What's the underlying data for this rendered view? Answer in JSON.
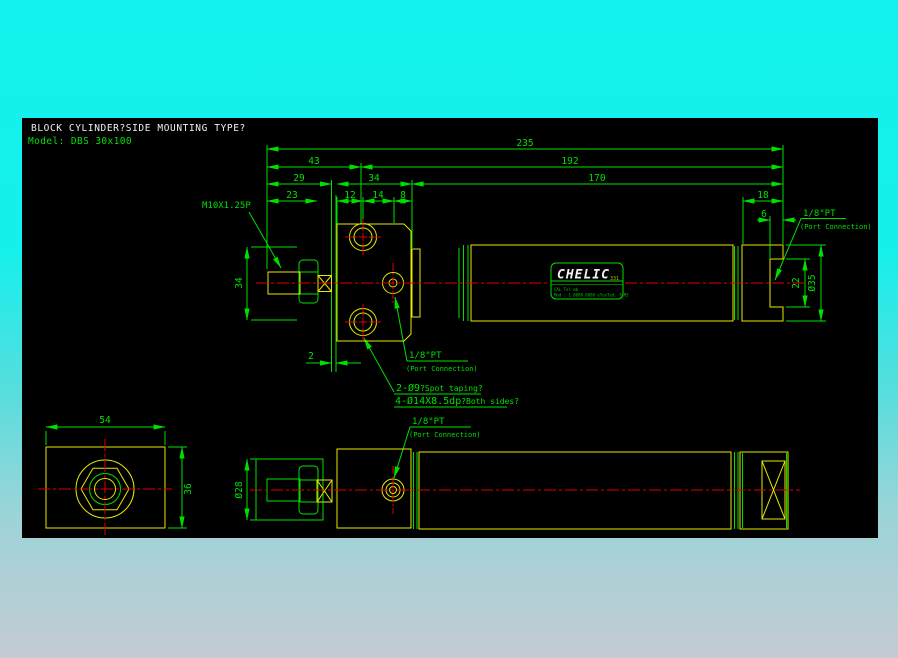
{
  "window": {
    "background_top": "#13f2ee",
    "background_bottom": "#c5cad3",
    "canvas_color": "#000000"
  },
  "colors": {
    "dimension_green": "#00e000",
    "object_yellow": "#e9e900",
    "centerline_red": "#e00000",
    "title_white": "#f0f0f0"
  },
  "header": {
    "title": "BLOCK CYLINDER?SIDE MOUNTING TYPE?",
    "model": "Model: DBS 30x100"
  },
  "dimensions": {
    "total_length": "235",
    "rod_to_hole_center": "43",
    "hole_center_to_end": "192",
    "rod_overhang": "29",
    "block_length": "34",
    "body_length": "170",
    "rod_thread_length": "23",
    "edge_to_hole": "12",
    "hole_to_port": "14",
    "port_to_face": "8",
    "cap_length": "18",
    "port_recess": "6",
    "mount_height": "34",
    "port_face_height": "22",
    "tube_diameter": "Ø35",
    "plate_thickness": "2",
    "block_width": "54",
    "block_depth": "36",
    "cover_diameter": "Ø28"
  },
  "labels": {
    "rod_thread": "M10X1.25P",
    "port": "1/8\"PT",
    "port_note": "(Port Connection)",
    "hole_note_main": "2-Ø9",
    "hole_note_sub": "?Spot taping?",
    "cbore_note_main": "4-Ø14X8.5dp",
    "cbore_note_sub": "?Both sides?"
  },
  "brand": {
    "name": "CHELIC",
    "code": "331",
    "fine_print_1": "CAL Tel mb",
    "fine_print_2": "Mod : 1.8088.8888  eTeeTed. TeMJ"
  }
}
